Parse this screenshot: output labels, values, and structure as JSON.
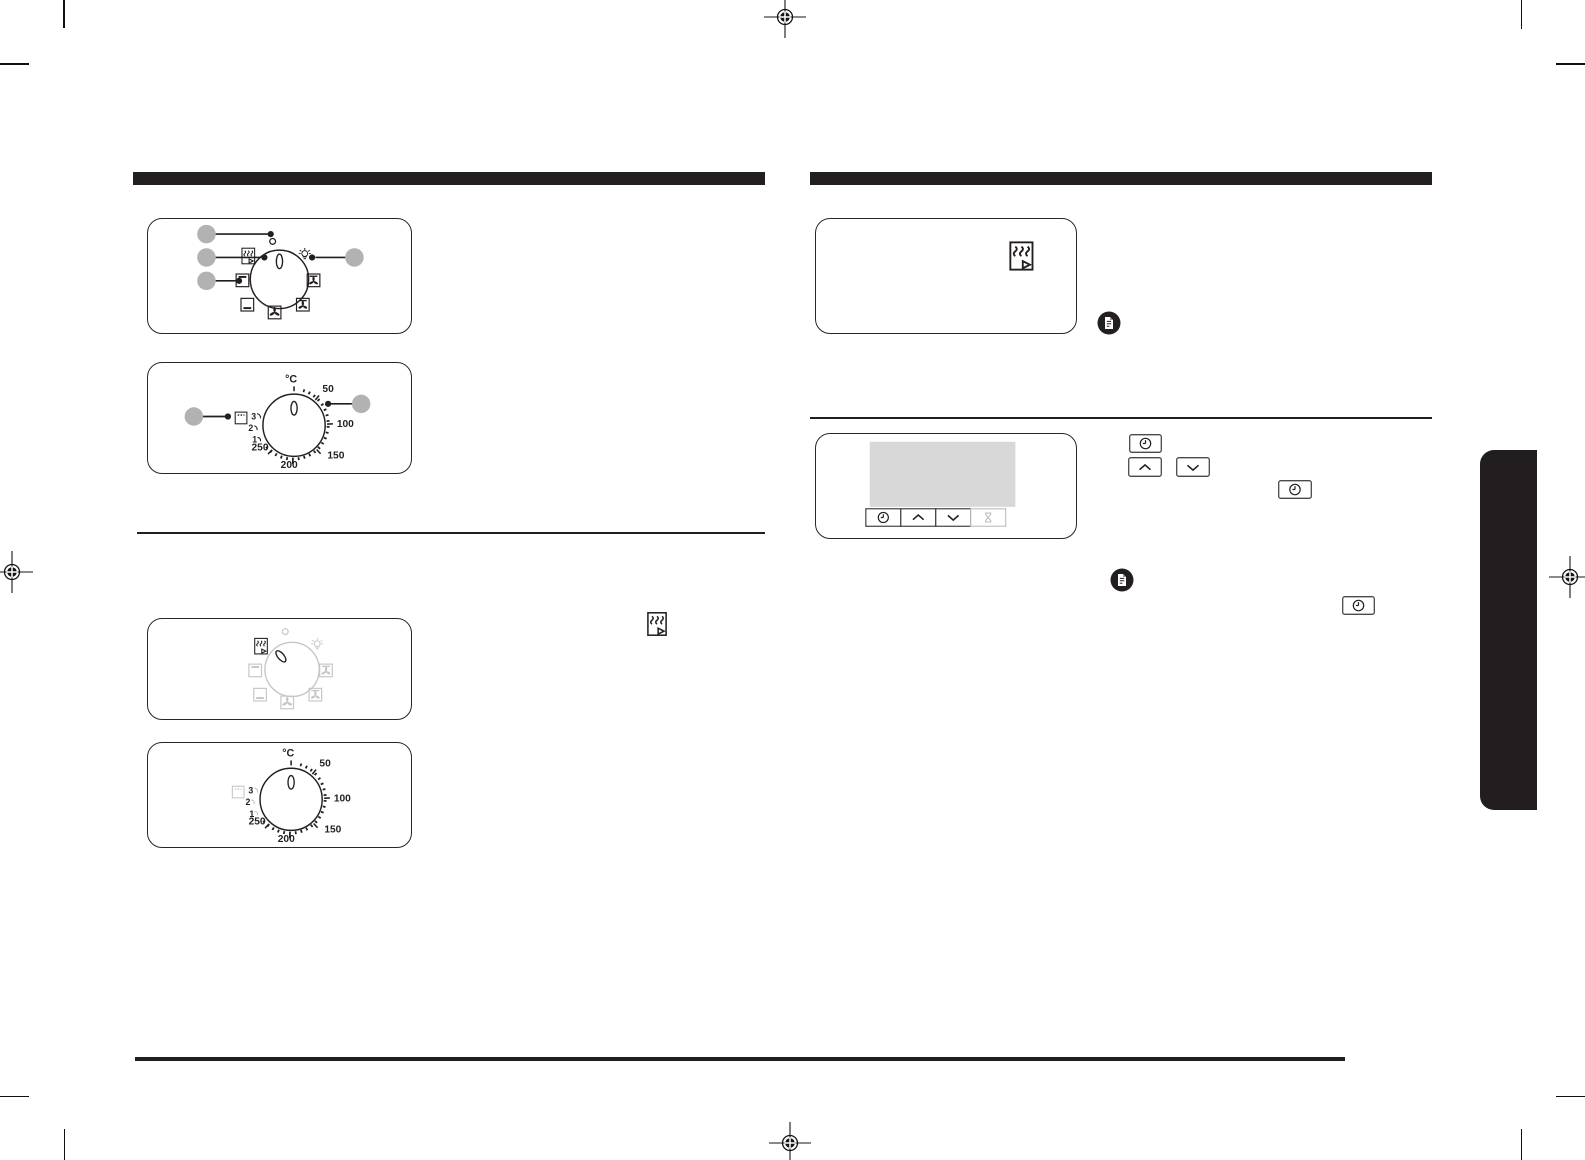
{
  "page": {
    "type": "oven-user-manual-print-proof-page",
    "background": "#ffffff",
    "ink": "#231f20"
  },
  "colors": {
    "callout_gray": "#b2b2b2",
    "disabled_gray": "#c6c6c6",
    "display_gray": "#d8d8d8",
    "side_tab_black": "#221e1f"
  },
  "temp_dial": {
    "unit": "°C",
    "labels": [
      "50",
      "100",
      "150",
      "200",
      "250"
    ],
    "grill_levels": [
      "3",
      "2",
      "1"
    ]
  },
  "mode_dial": {
    "positions": [
      "off-marker",
      "grill-fan",
      "lamp",
      "top-heat",
      "bottom-heat",
      "fan-top-heat",
      "fan-bottom-heat",
      "convection-fan"
    ],
    "callout_count": 4
  },
  "timer_panel": {
    "buttons": [
      "timer",
      "up",
      "down",
      "hourglass"
    ]
  },
  "inline_controls": {
    "buttons": [
      "timer",
      "up",
      "down",
      "timer",
      "timer"
    ],
    "note_icons": 2
  }
}
